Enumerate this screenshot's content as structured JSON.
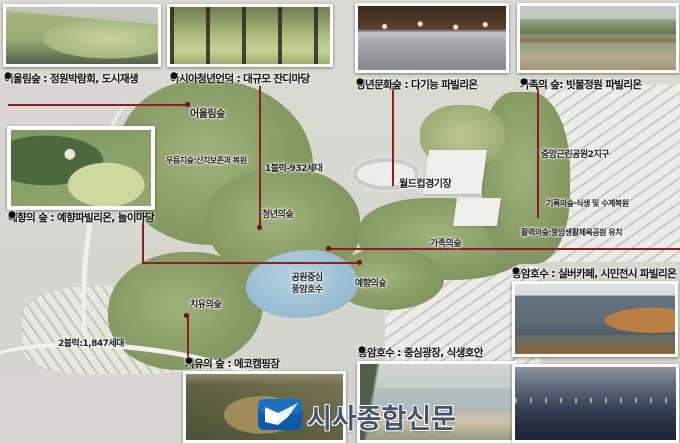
{
  "top_photos": [
    {
      "bullet": "●",
      "caption": "어울림숲 : 정원박람회, 도시재생"
    },
    {
      "bullet": "●",
      "caption": "아시아청년언덕 : 대규모 잔디마당"
    },
    {
      "bullet": "●",
      "caption": "청년문화숲 : 다기능 파빌리온"
    },
    {
      "bullet": "●",
      "caption": "가족의 숲: 빗물정원 파빌리온"
    }
  ],
  "insets": {
    "yehyang": {
      "bullet": "●",
      "caption": "예향의 숲 : 예향파빌리온, 놀이마당"
    },
    "chiyu": {
      "bullet": "●",
      "caption": "치유의 숲 : 에코캠핑장"
    },
    "pungam_plaza": {
      "bullet": "●",
      "caption": "풍암호수 : 중심광장, 식생호안"
    },
    "pungam_cafe": {
      "bullet": "●",
      "caption": "풍암호수 : 실버카페, 시민전시 파빌리온"
    }
  },
  "map_labels": {
    "eoullim": "어울림숲",
    "udeumji": "우듬지숲:산지보존과 복원",
    "block1": "1블럭-932세대",
    "cheongnyeon": "청년의숲",
    "worldcup": "월드컵경기장",
    "jungang_park": "중앙근린공원2지구",
    "girok": "기록의숲·식생 및 수계복원",
    "hwallyeok": "활력의숲:풍암생활체육공원 유치",
    "gajok": "가족의숲",
    "yehyang": "예향의숲",
    "lake_line1": "공원중심",
    "lake_line2": "풍암호수",
    "chiyu": "치유의숲",
    "block2": "2블럭:1,847세대"
  },
  "logo": {
    "text": "시사종합신문"
  },
  "colors": {
    "leader_line": "#8a1f1f",
    "lake": "#9cc0d4",
    "forest": "#869963",
    "logo_blue": "#1266b4",
    "logo_text": "#45536b",
    "background": "#e6e4de"
  }
}
